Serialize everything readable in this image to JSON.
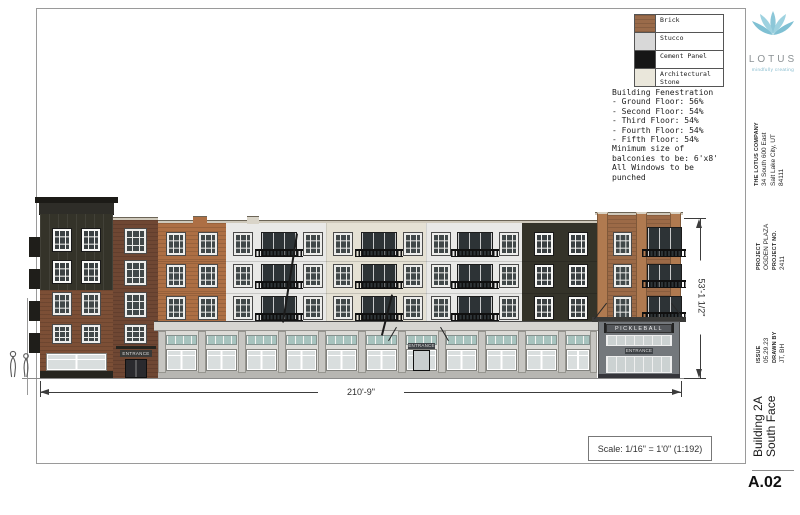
{
  "legend": {
    "items": [
      {
        "label": "Brick",
        "color": "#9a6b4a"
      },
      {
        "label": "Stucco",
        "color": "#d8d8d8"
      },
      {
        "label": "Cement Panel",
        "color": "#161616"
      },
      {
        "label": "Architectural Stone",
        "color": "#eae7db"
      }
    ]
  },
  "notes": {
    "lines": [
      "Building Fenestration",
      "- Ground Floor: 56%",
      "- Second Floor: 54%",
      "- Third Floor: 54%",
      "- Fourth Floor: 54%",
      "- Fifth Floor: 54%",
      "Minimum size of",
      "balconies to be: 6'x8'",
      "All Windows to be",
      "punched"
    ]
  },
  "dimensions": {
    "width": "210'-9\"",
    "height": "53'-1 1/2\""
  },
  "scale_text": "Scale: 1/16\" = 1'0\" (1:192)",
  "building": {
    "pickleball_sign": "PICKLEBALL",
    "pickleball_entrance": "ENTRANCE",
    "left_entrance": "ENTRANCE",
    "center_entrance": "ENTRANCE"
  },
  "titleblock": {
    "logo_name": "LOTUS",
    "logo_tagline": "mindfully creating",
    "company": {
      "name": "THE LOTUS COMPANY",
      "address_line1": "34 South 600 East",
      "address_line2": "Salt Lake City, UT",
      "address_line3": "84111"
    },
    "project": {
      "label": "PROJECT",
      "name": "OGDEN PLAZA",
      "number_label": "PROJECT NO.",
      "number": "2411"
    },
    "issue": {
      "label": "ISSUE",
      "date": "05.29.23",
      "drawn_label": "DRAWN BY",
      "drawn_by": "JT, BH"
    },
    "sheet": {
      "title_line1": "Building 2A",
      "title_line2": "South Face",
      "number": "A.02"
    }
  }
}
